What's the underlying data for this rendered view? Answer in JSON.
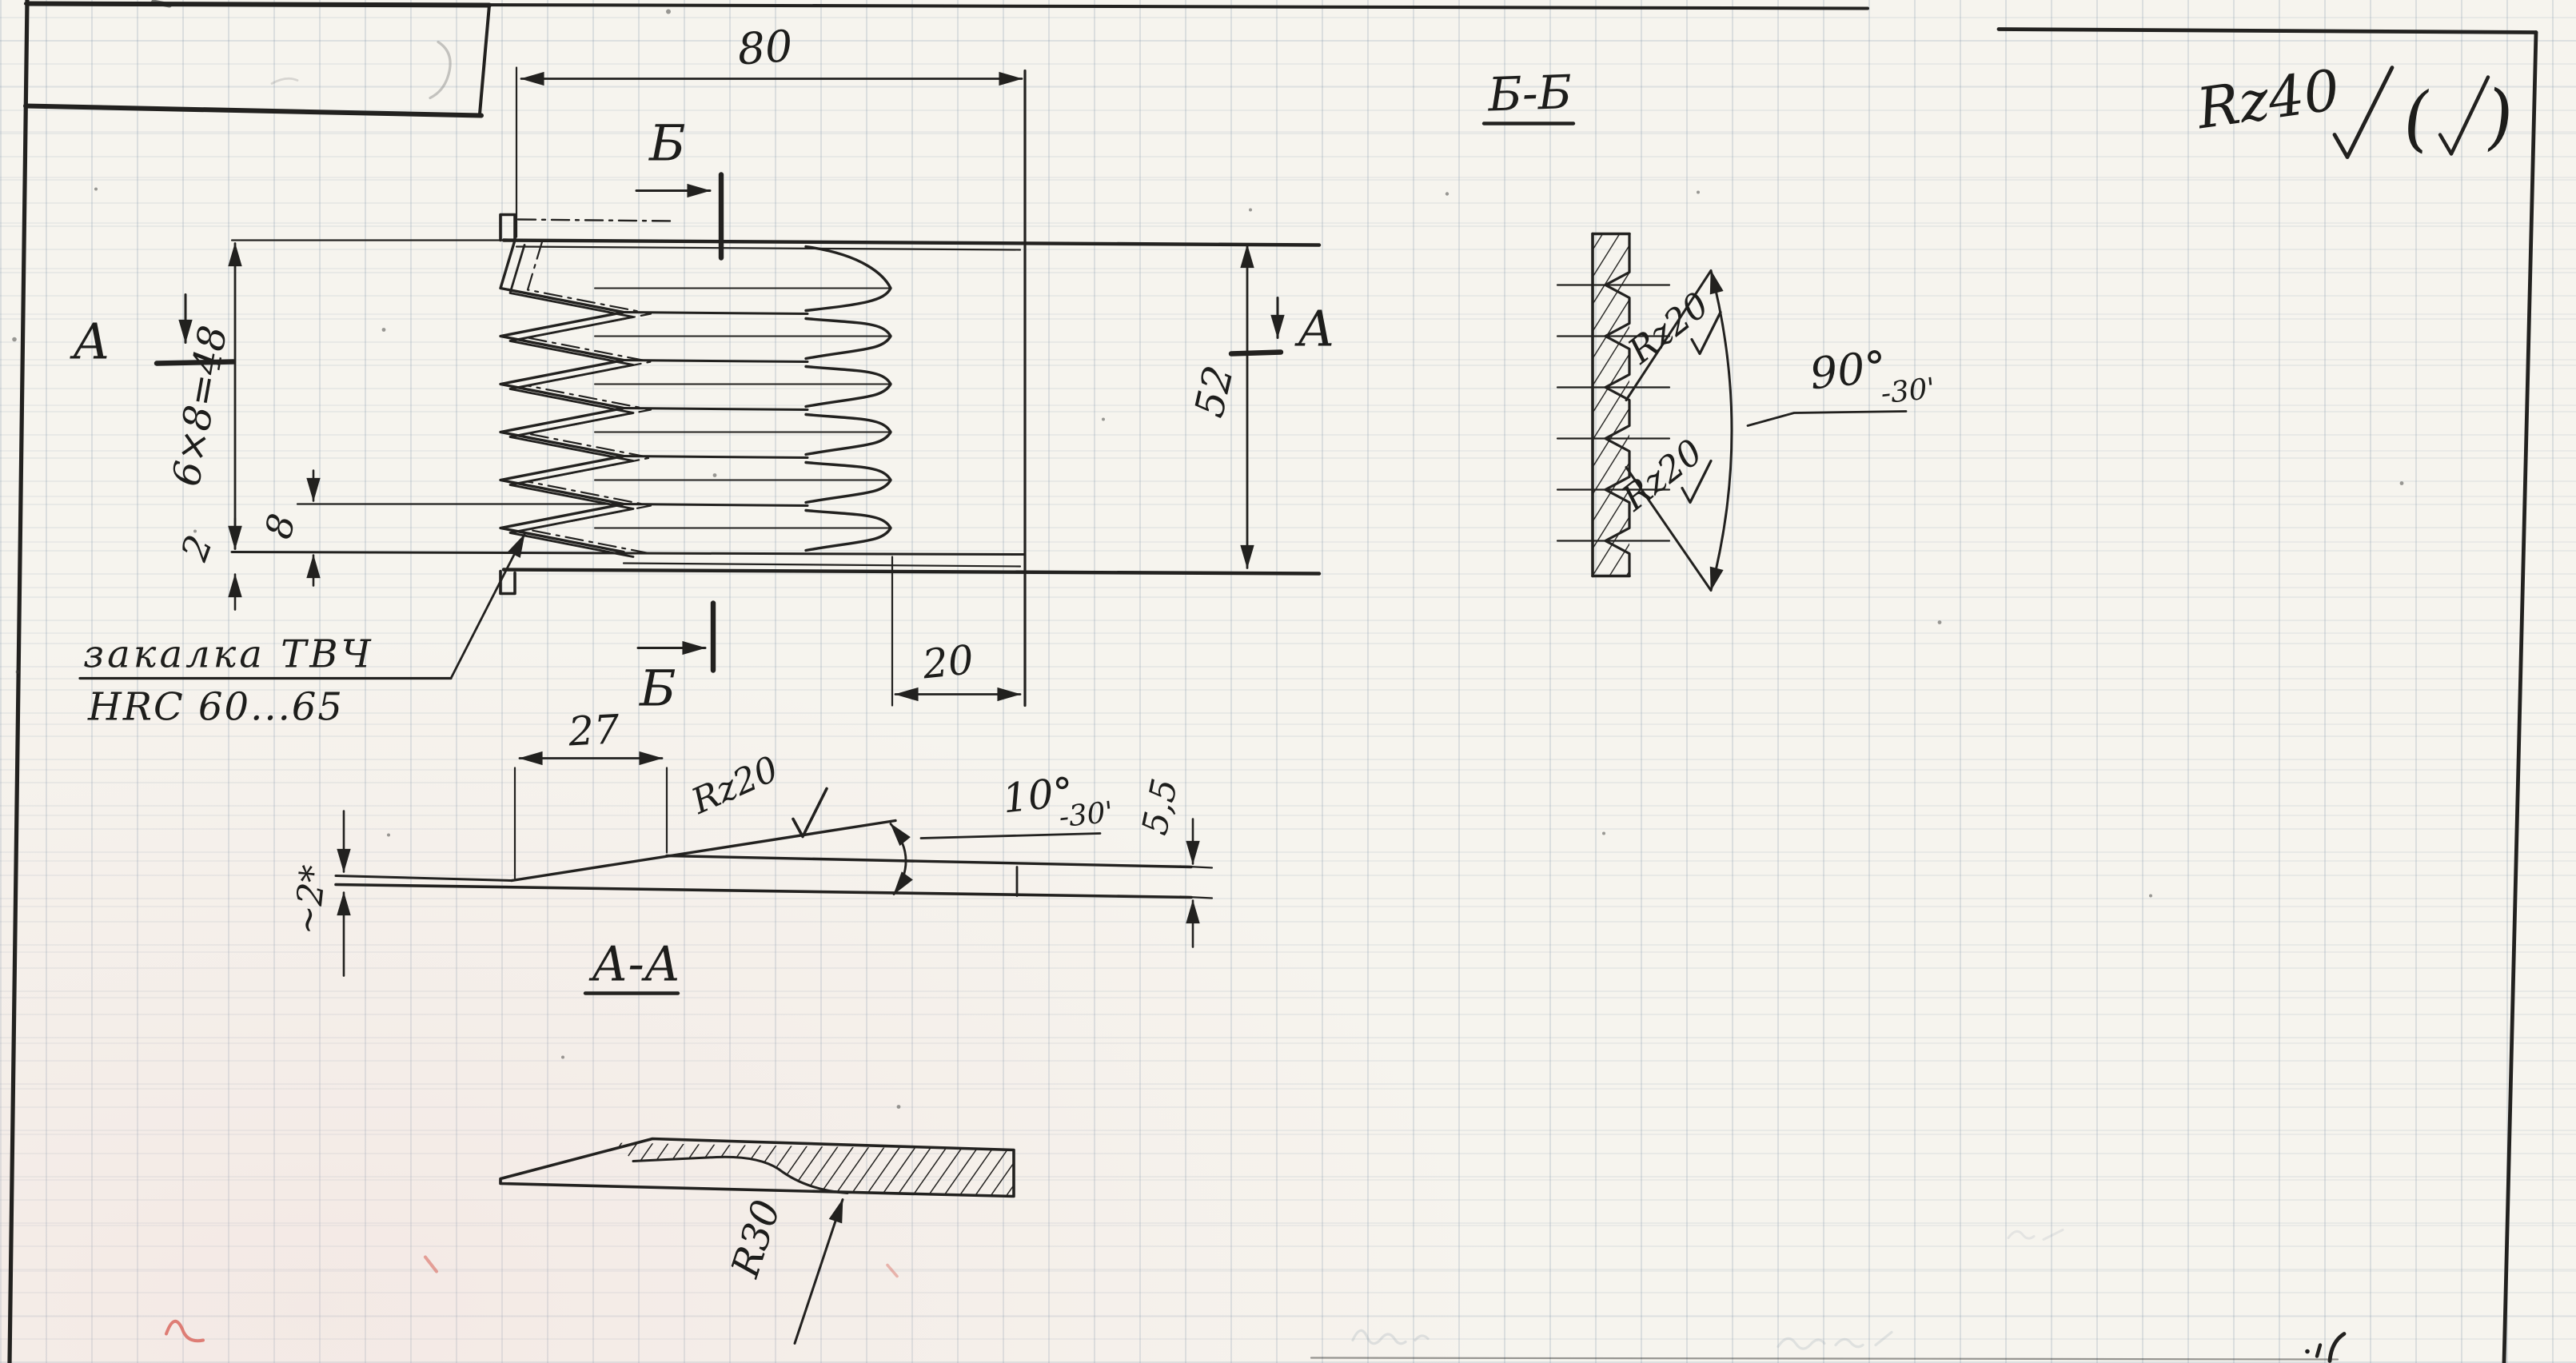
{
  "colors": {
    "paper": "#f6f4ee",
    "ink": "#22211f",
    "grid_blue": "#6e87a0",
    "red_pen": "#d96a60"
  },
  "notes": {
    "general_roughness": "Rz40",
    "paren_open": "(",
    "paren_close": ")",
    "hardening_line1": "закалка ТВЧ",
    "hardening_line2": "HRC 60...65"
  },
  "main_view": {
    "dim_length": "80",
    "dim_width": "52",
    "dim_plain_zone": "20",
    "dim_pitch": "8",
    "dim_base": "2",
    "dim_serration": "6×8=48",
    "cut_label_b_top": "Б",
    "cut_label_b_bottom": "Б",
    "cut_label_a_left": "A",
    "cut_label_a_right": "A"
  },
  "section_aa": {
    "title": "А-А",
    "dim_bevel": "27",
    "roughness": "Rz20",
    "dim_angle": "10°",
    "dim_angle_tol": "-30'",
    "dim_thickness": "5,5",
    "dim_edge": "~2*",
    "dim_radius": "R30"
  },
  "section_bb": {
    "title": "Б-Б",
    "roughness_upper": "Rz20",
    "roughness_lower": "Rz20",
    "dim_angle": "90°",
    "dim_angle_tol": "-30'"
  }
}
